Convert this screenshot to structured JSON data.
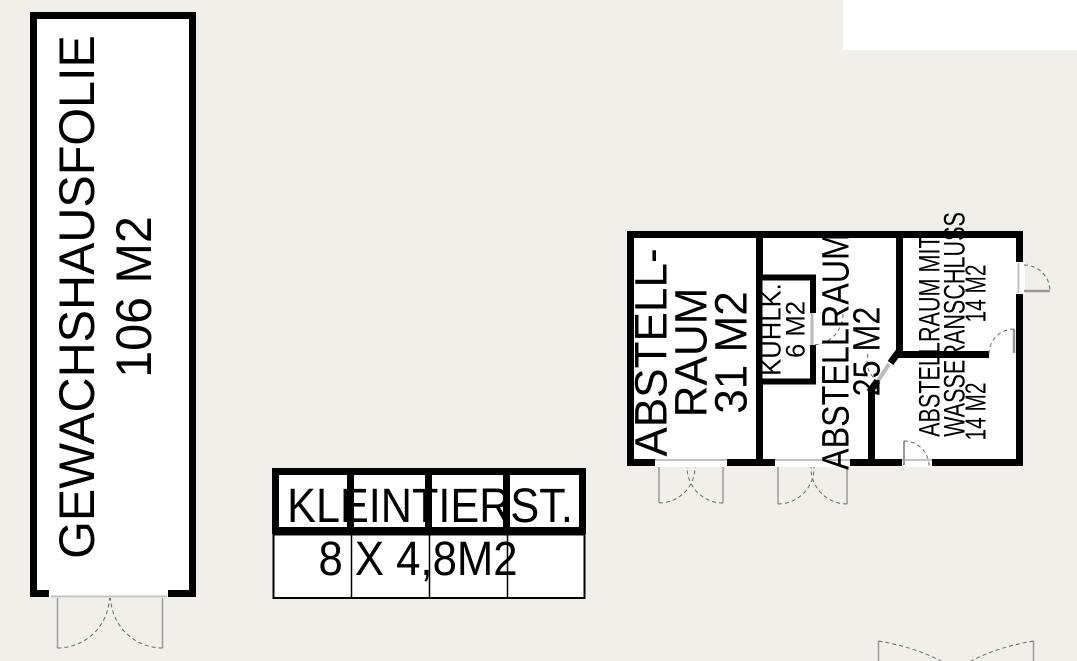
{
  "plan_title": "Site outbuildings floor plan",
  "colors": {
    "background": "#f0efe9",
    "wall": "#000000",
    "room_fill": "#ffffff",
    "door_leaf": "#9a9a9a",
    "door_arc": "#6a6a6a",
    "threshold": "#c2c2c2",
    "text": "#000000"
  },
  "greenhouse": {
    "name": "GEWACHSHAUSFOLIE",
    "area": "106 M2"
  },
  "shed": {
    "name": "KLEINTIERST.",
    "size": "8 X 4,8M2"
  },
  "outbuilding": {
    "storage_room_left": {
      "line1": "ABSTELL-",
      "line2": "RAUM",
      "line3": "31 M2"
    },
    "cooling_room": {
      "line1": "KÜHLK.",
      "line2": "6 M2"
    },
    "storage_room_middle": {
      "line1": "ABSTELLRAUM",
      "line2": "25 M2"
    },
    "storage_rooms_with_water": {
      "line1": "ABSTELLRAUM MIT",
      "line2": "WASSERANSCHLUSS",
      "area_upper": "14 M2",
      "area_lower": "14 M2"
    }
  }
}
